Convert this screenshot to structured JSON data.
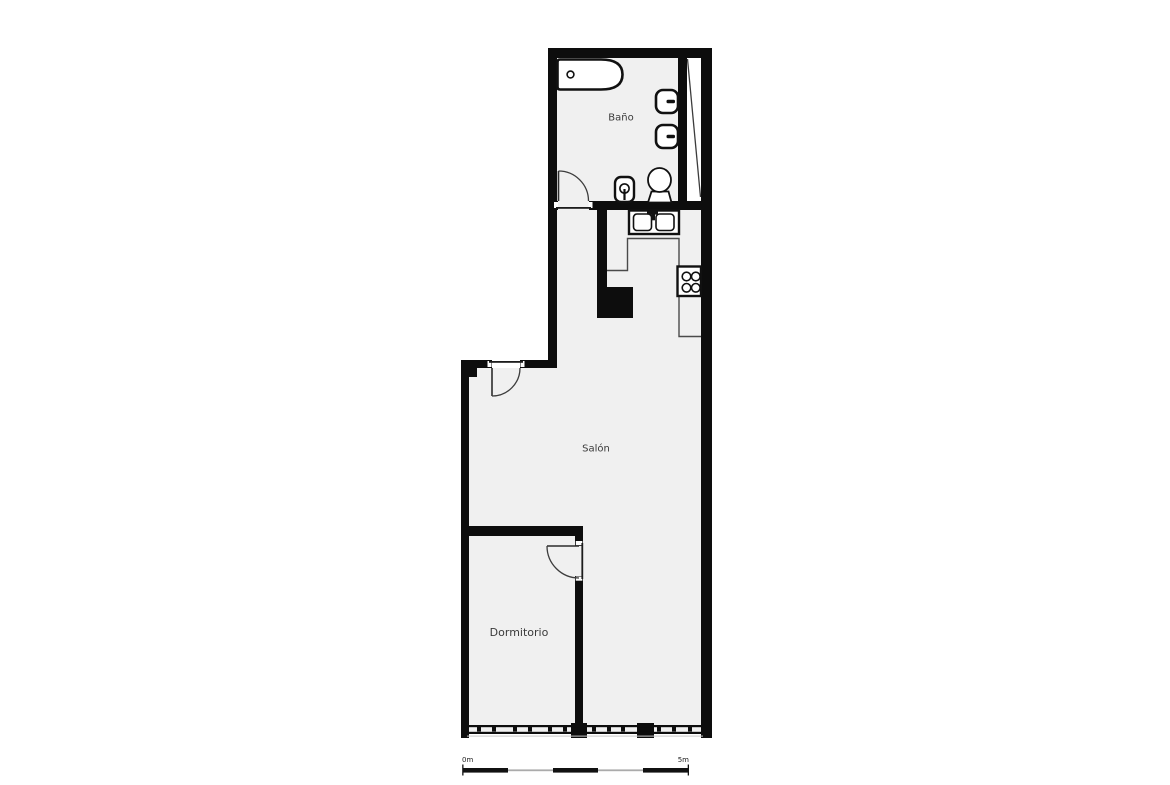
{
  "page": {
    "type": "floor-plan"
  },
  "rooms": {
    "bathroom": {
      "label": "Baño"
    },
    "living_room": {
      "label": "Salón"
    },
    "bedroom": {
      "label": "Dormitorio"
    }
  },
  "scale_bar": {
    "start_label": "0m",
    "end_label": "5m",
    "segments": 5
  },
  "colors": {
    "background": "#ffffff",
    "wall": "#0d0d0d",
    "floor": "#f0f0f0",
    "fixture_fill": "#ffffff",
    "fixture_stroke": "#111111",
    "label_text": "#3a3a3a",
    "scale_gray": "#ababab"
  },
  "fixtures": [
    "bathtub",
    "bath-drain",
    "towel-radiator-upper",
    "towel-radiator-lower",
    "toilet",
    "washbasin",
    "kitchen-sink",
    "kitchen-faucet",
    "kitchen-counter",
    "stove",
    "column-block",
    "shaft-diagonal",
    "window-wall",
    "bathroom-door",
    "entrance-door",
    "bedroom-door"
  ]
}
